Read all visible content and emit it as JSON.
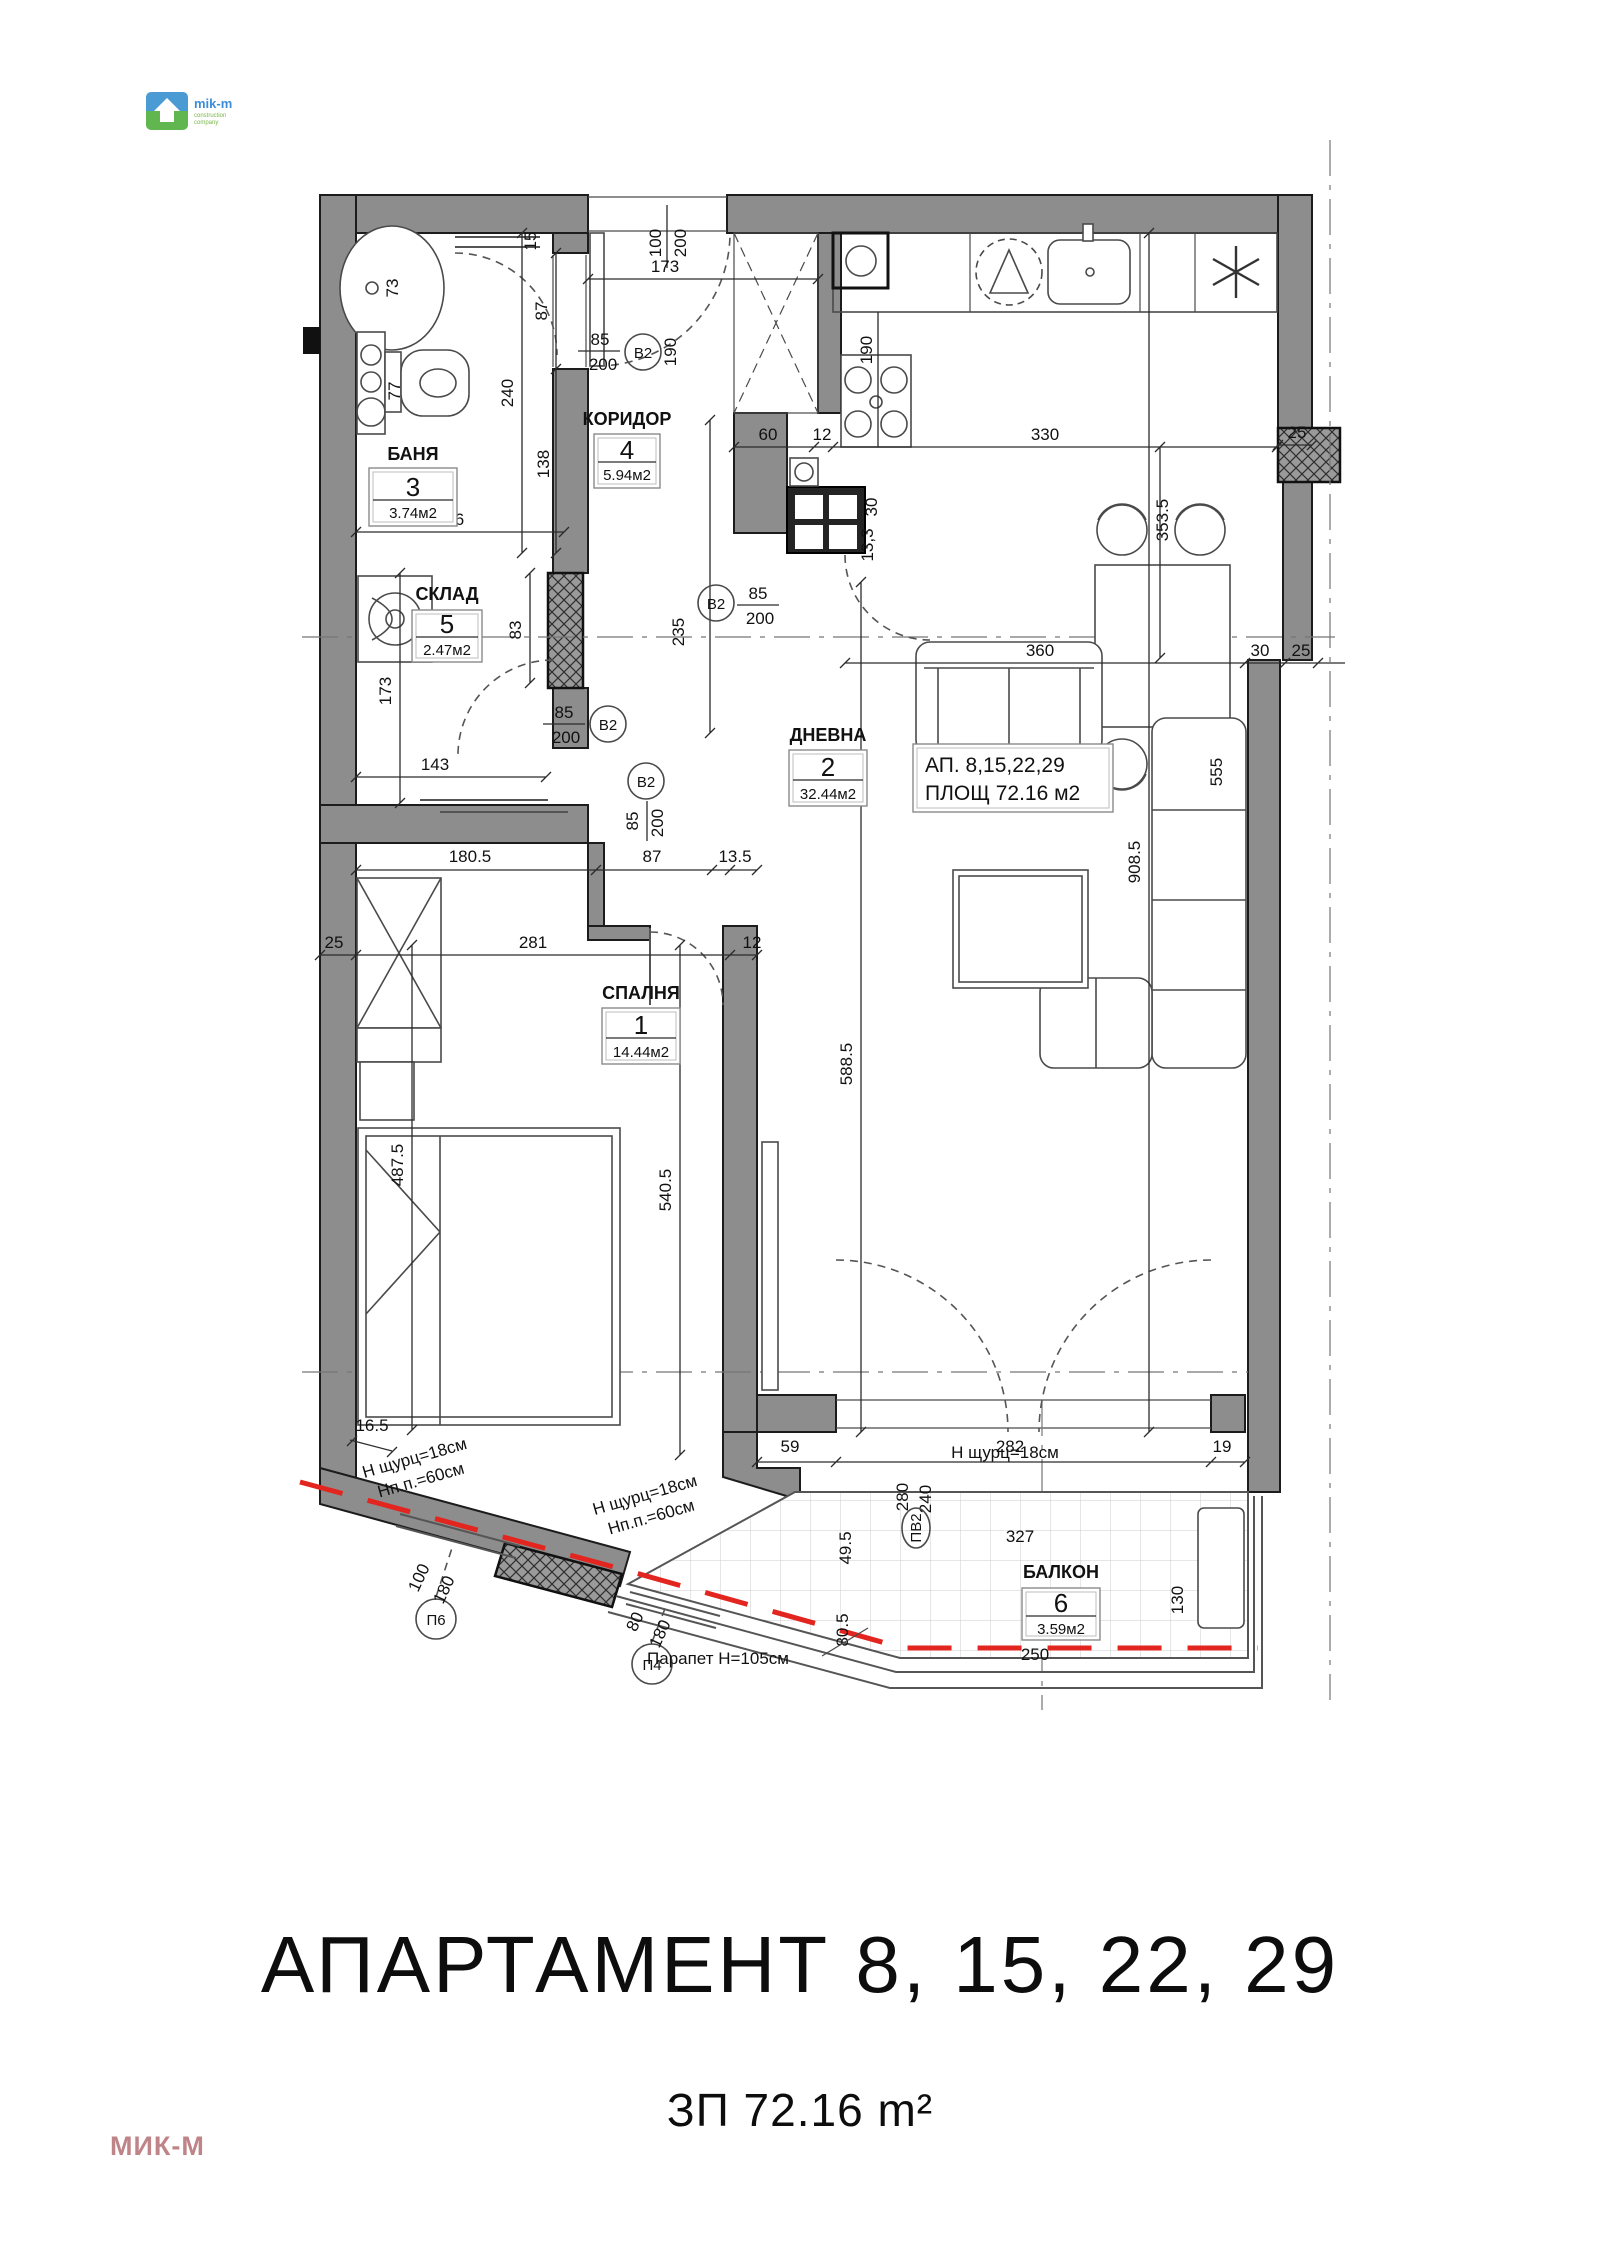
{
  "header": {
    "logo_text": "mik-m",
    "logo_sub1": "construction",
    "logo_sub2": "company"
  },
  "footer": {
    "title": "АПАРТАМЕНТ 8, 15, 22, 29",
    "subtitle": "ЗП 72.16 m²",
    "watermark": "МИК-М"
  },
  "apartment_box": {
    "line1": "АП.  8,15,22,29",
    "line2": "ПЛОЩ 72.16 м2"
  },
  "rooms": {
    "bedroom": {
      "name": "СПАЛНЯ",
      "number": "1",
      "area": "14.44м2"
    },
    "living": {
      "name": "ДНЕВНА",
      "number": "2",
      "area": "32.44м2"
    },
    "bath": {
      "name": "БАНЯ",
      "number": "3",
      "area": "3.74м2"
    },
    "corridor": {
      "name": "КОРИДОР",
      "number": "4",
      "area": "5.94м2"
    },
    "storage": {
      "name": "СКЛАД",
      "number": "5",
      "area": "2.47м2"
    },
    "balcony": {
      "name": "БАЛКОН",
      "number": "6",
      "area": "3.59м2"
    }
  },
  "doors": {
    "b2": "В2",
    "pv2": "ПВ2",
    "p6": "П6",
    "p4": "П4"
  },
  "dims": {
    "v12": "12",
    "v13_3": "13,3",
    "v15": "15",
    "v16_5": "16.5",
    "v19": "19",
    "v25": "25",
    "v30": "30",
    "v49_5": "49.5",
    "v59": "59",
    "v60": "60",
    "v73": "73",
    "v77": "77",
    "v80": "80",
    "v80_5": "80.5",
    "v83": "83",
    "v85": "85",
    "v87": "87",
    "v100": "100",
    "v130": "130",
    "v135": "13.5",
    "v138": "138",
    "v143": "143",
    "v156": "156",
    "v173": "173",
    "v180": "180",
    "v180_5": "180.5",
    "v190": "190",
    "v200": "200",
    "v235": "235",
    "v240": "240",
    "v250": "250",
    "v280": "280",
    "v281": "281",
    "v282": "282",
    "v327": "327",
    "v330": "330",
    "v353_5": "353.5",
    "v360": "360",
    "v487_5": "487.5",
    "v540_5": "540.5",
    "v555": "555",
    "v588_5": "588.5",
    "v908_5": "908.5"
  },
  "annotations": {
    "shurts": "Н щурц=18см",
    "npp": "Нп.п.=60см",
    "parapet": "Парапет Н=105см"
  }
}
